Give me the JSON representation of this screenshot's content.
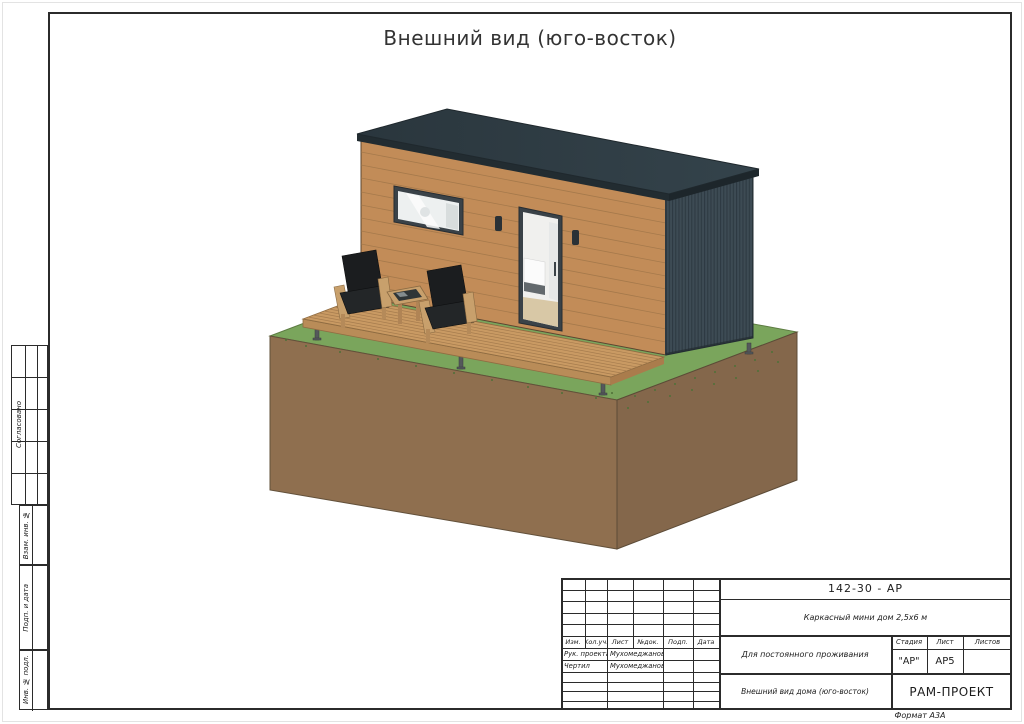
{
  "sheet": {
    "title": "Внешний вид (юго-восток)",
    "format_note": "Формат А3А"
  },
  "sidebar": {
    "approval_label": "Согласовано",
    "items": [
      "Взам. инв. №",
      "Подп. и дата",
      "Инв. № подл."
    ]
  },
  "stamp": {
    "doc_number": "142-30 - АР",
    "project_name": "Каркасный мини дом 2,5х6 м",
    "purpose": "Для постоянного проживания",
    "view_title": "Внешний вид дома (юго-восток)",
    "company": "РАМ-ПРОЕКТ",
    "columns": [
      "Изм.",
      "Кол.уч.",
      "Лист",
      "№док.",
      "Подп.",
      "Дата"
    ],
    "rows": [
      {
        "role": "Рук. проекта",
        "name": "Мухомеджанов"
      },
      {
        "role": "Чертил",
        "name": "Мухомеджанов"
      }
    ],
    "stage_label": "Стадия",
    "sheet_label": "Лист",
    "sheets_label": "Листов",
    "stage_value": "\"АР\"",
    "sheet_value": "АР5",
    "sheets_value": ""
  },
  "drawing": {
    "subject": "Каркасный мини дом 2,5х6 м — внешний вид (юго-восток)",
    "palette": {
      "roof": "#2d3a41",
      "siding": "#c28c58",
      "end_wall": "#3c4a52",
      "deck": "#c99a63",
      "grass": "#7aa55c",
      "soil_front": "#8f6f4f",
      "soil_side": "#84674b",
      "frames": "#3a4248",
      "cushions": "#1c1e20"
    }
  }
}
